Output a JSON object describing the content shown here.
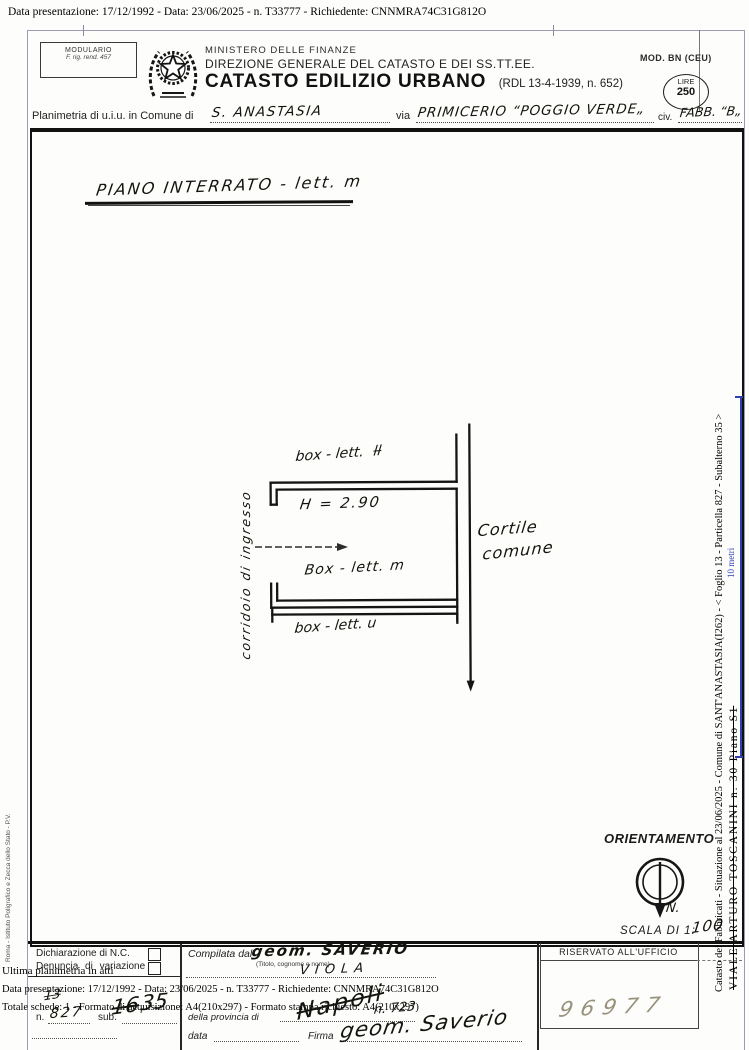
{
  "top_bar": {
    "text": "Data presentazione: 17/12/1992 - Data: 23/06/2025 - n. T33777 - Richiedente: CNNMRA74C31G812O"
  },
  "header": {
    "modulario_title": "MODULARIO",
    "modulario_ref": "F. rig. rend. 457",
    "ministry": "MINISTERO DELLE FINANZE",
    "direction": "DIREZIONE GENERALE DEL CATASTO E DEI SS.TT.EE.",
    "title": "CATASTO EDILIZIO URBANO",
    "law_ref": "(RDL 13-4-1939, n. 652)",
    "mod_label": "MOD. BN (CEU)",
    "lire_label": "LIRE",
    "lire_value": "250"
  },
  "location": {
    "prefix": "Planimetria di u.i.u. in Comune di",
    "comune": "S. ANASTASIA",
    "via_label": "via",
    "via_value": "PRIMICERIO “POGGIO VERDE„",
    "civ_label": "civ.",
    "civ_value": "FABB. “B„"
  },
  "plan": {
    "floor_title": "PIANO INTERRATO - lett. m",
    "box_top_label": "box - lett.",
    "box_top_struck": "ll",
    "height_note": "H = 2.90",
    "box_mid_label": "Box - lett. m",
    "box_bottom_label": "box - lett. u",
    "corridor_label": "corridoio di ingresso",
    "courtyard_line1": "Cortile",
    "courtyard_line2": "comune"
  },
  "orientation": {
    "title": "ORIENTAMENTO",
    "north": "N.",
    "scale_label": "SCALA DI 1:",
    "scale_value": "100"
  },
  "right_margin": {
    "situazione": "Catasto dei Fabbricati - Situazione al 23/06/2025 - Comune di SANT'ANASTASIA(I262) - < Foglio 13 - Particella 827 - Subalterno 35 >",
    "address": "VIALE ARTURO TOSCANINI n. 30 Piano S1",
    "scale_bar": "10 metri",
    "scale_color": "#2f3fae"
  },
  "left_margin": {
    "credit": "Roma - Istituto Poligrafico e Zecca dello Stato - P.V."
  },
  "footer": {
    "decl_nc": "Dichiarazione di N.C.",
    "decl_var": "Denuncia di variazione",
    "ultima": "Ultima planimetria in atti",
    "data_line": "Data presentazione: 17/12/1992 - Data: 23/06/2025 - n. T33777 - Richiedente: CNNMRA74C31G812O",
    "totale_line": "Totale schede: 1 - Formato di acquisizione: A4(210x297) - Formato stampa richiesto: A4(210x297)",
    "n_label": "n.",
    "sub_label": "sub.",
    "hand_note": "13",
    "hand_n": "827",
    "hand_sub_struck": "16",
    "hand_sub": "35",
    "compilata_label": "Compilata dal",
    "compiler": "geom. SAVERIO",
    "compiler_hint": "(Titolo, cognome e nome)",
    "compiler_surname": "VIOLA",
    "provincia_label": "della provincia di",
    "provincia_scrawl": "Napoli",
    "provincia_num": "n. 723",
    "data_label": "data",
    "firma_label": "Firma",
    "signature": "geom. Saverio",
    "riservato": "RISERVATO ALL'UFFICIO",
    "protocol": "96977"
  }
}
